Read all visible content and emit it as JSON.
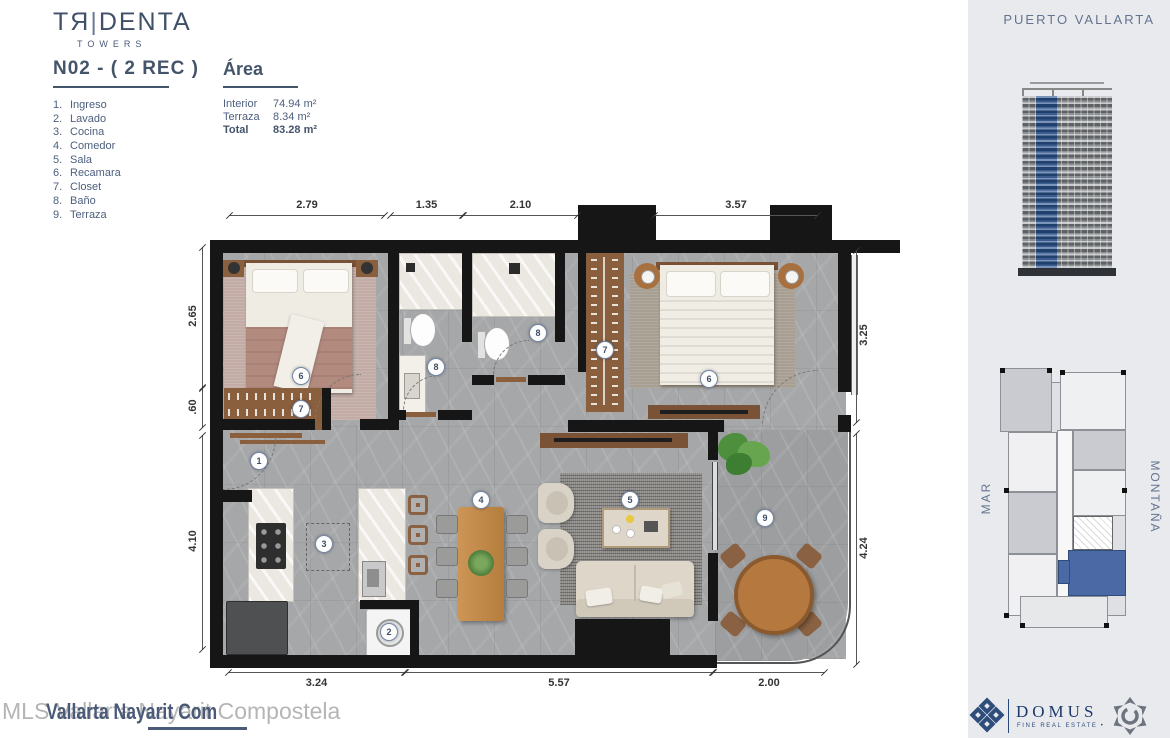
{
  "brand": {
    "name": "TЯ|DENTA",
    "sub": "TOWERS"
  },
  "unit": {
    "title": "N02 - ( 2 REC )"
  },
  "legend": {
    "items": [
      {
        "num": "1.",
        "label": "Ingreso"
      },
      {
        "num": "2.",
        "label": "Lavado"
      },
      {
        "num": "3.",
        "label": "Cocina"
      },
      {
        "num": "4.",
        "label": "Comedor"
      },
      {
        "num": "5.",
        "label": "Sala"
      },
      {
        "num": "6.",
        "label": "Recamara"
      },
      {
        "num": "7.",
        "label": "Closet"
      },
      {
        "num": "8.",
        "label": "Baño"
      },
      {
        "num": "9.",
        "label": "Terraza"
      }
    ]
  },
  "area": {
    "title": "Área",
    "rows": [
      {
        "label": "Interior",
        "value": "74.94 m²"
      },
      {
        "label": "Terraza",
        "value": "8.34 m²"
      },
      {
        "label": "Total",
        "value": "83.28 m²"
      }
    ]
  },
  "plan": {
    "tags": [
      "1",
      "2",
      "3",
      "4",
      "5",
      "6",
      "6",
      "7",
      "7",
      "8",
      "8",
      "9"
    ],
    "dims_top": [
      "2.79",
      "1.35",
      "2.10",
      "3.57"
    ],
    "dims_left": [
      "2.65",
      ".60",
      "4.10"
    ],
    "dims_right": [
      "3.25",
      "4.24"
    ],
    "dims_bottom": [
      "3.24",
      "5.57",
      "2.00"
    ]
  },
  "sidebar": {
    "location": "PUERTO VALLARTA",
    "mar": "MAR",
    "montana": "MONTAÑA"
  },
  "footer": {
    "watermark": "MLS Vallarta Nayarit Compostela",
    "watermark_overlay": "Vallarta Nayarit Com",
    "domus": "DOMUS",
    "domus_tagline": "FINE REAL ESTATE  •"
  },
  "colors": {
    "accent": "#44546a",
    "highlight_blue": "#4a69a5",
    "wood": "#8a5f3e"
  }
}
